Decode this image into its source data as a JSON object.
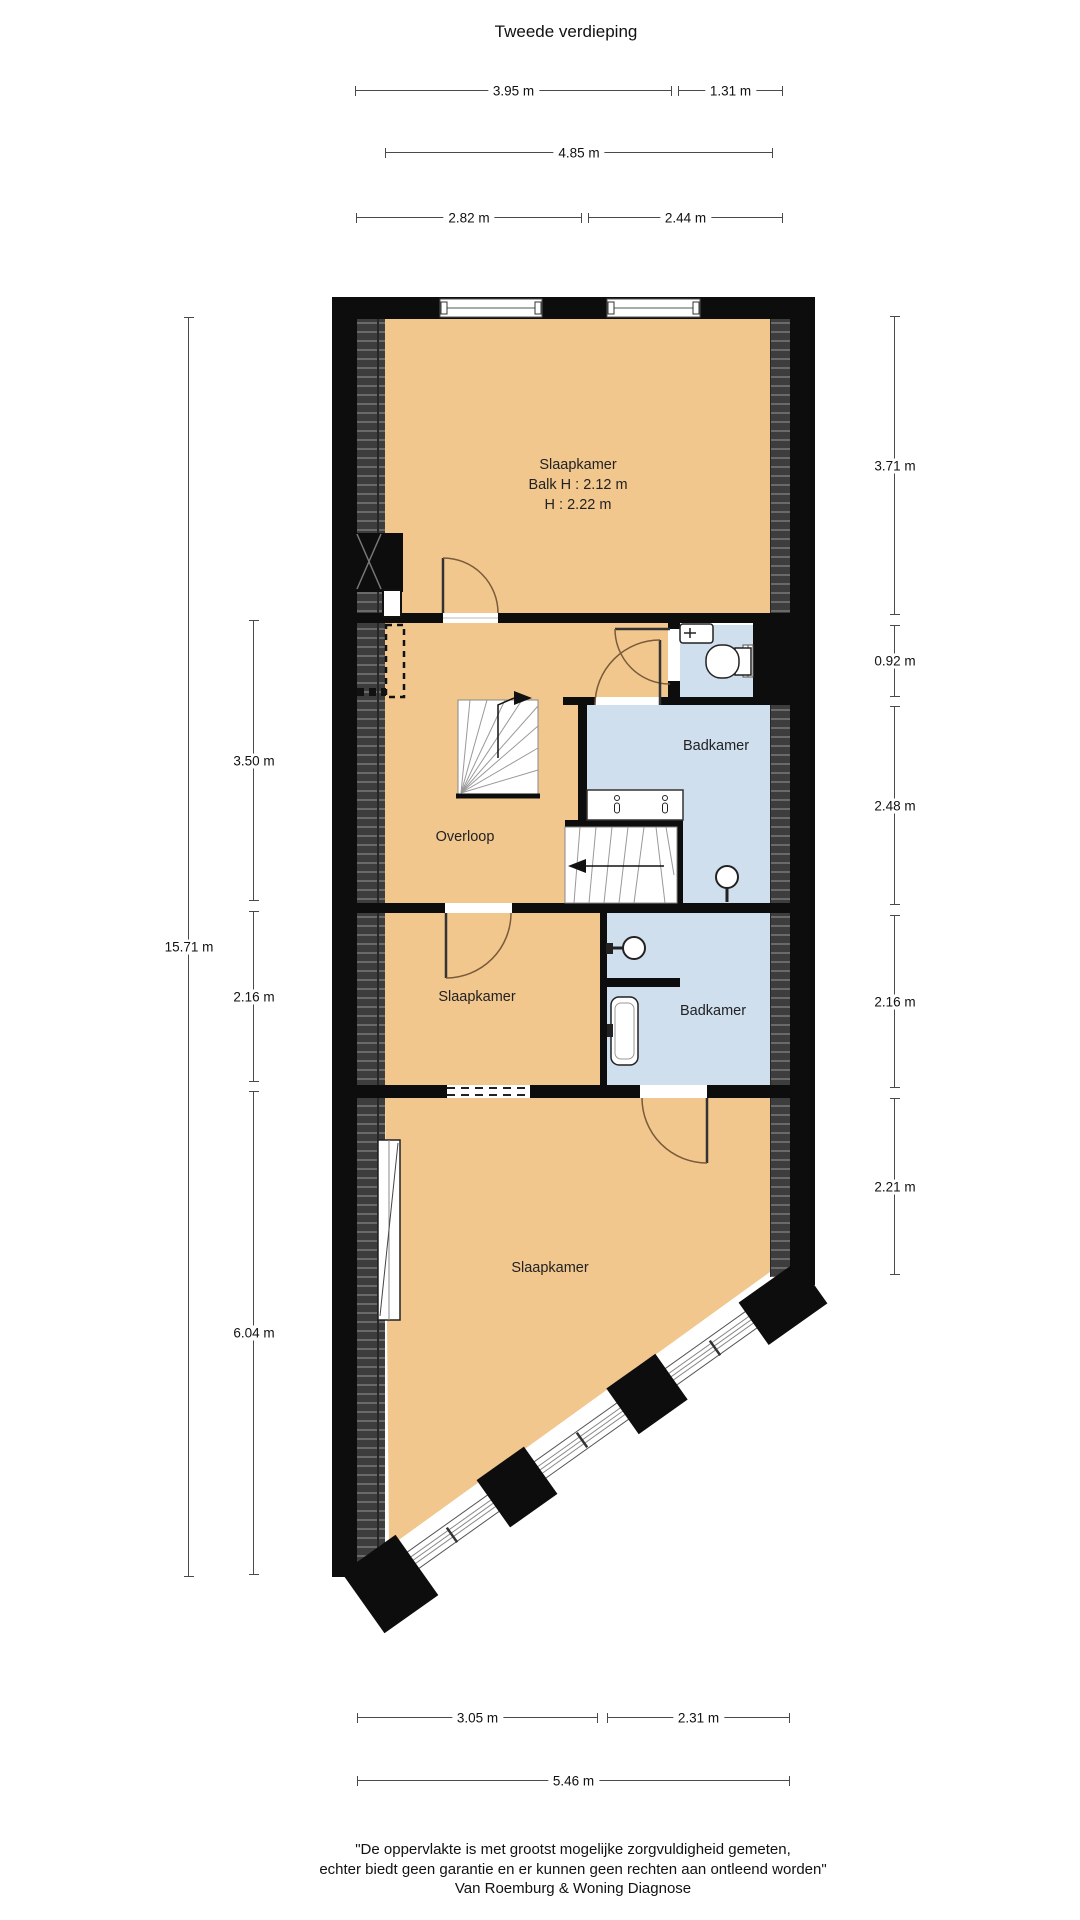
{
  "title": "Tweede verdieping",
  "dims": {
    "top": {
      "d395": "3.95 m",
      "d131": "1.31 m",
      "d485": "4.85 m",
      "d282": "2.82 m",
      "d244": "2.44 m"
    },
    "left": {
      "total": "15.71 m",
      "hall": "3.50 m",
      "row": "2.16 m",
      "bottom": "6.04 m"
    },
    "right": {
      "bedroom": "3.71 m",
      "toilet": "0.92 m",
      "bath": "2.48 m",
      "row": "2.16 m",
      "lower": "2.21 m"
    },
    "bottom": {
      "d305": "3.05 m",
      "d231": "2.31 m",
      "d546": "5.46 m"
    }
  },
  "rooms": {
    "bedroom_top": {
      "name": "Slaapkamer",
      "beam": "Balk H : 2.12 m",
      "height": "H : 2.22 m"
    },
    "hall": {
      "name": "Overloop"
    },
    "bathroom_main": {
      "name": "Badkamer"
    },
    "bedroom_small": {
      "name": "Slaapkamer"
    },
    "bathroom_second": {
      "name": "Badkamer"
    },
    "bedroom_large": {
      "name": "Slaapkamer"
    }
  },
  "fixtures": [
    "toilet",
    "hand-basin",
    "double-sink-counter",
    "shower-head",
    "washbasin",
    "staircase"
  ],
  "footer": {
    "line1": "\"De oppervlakte is met grootst mogelijke zorgvuldigheid gemeten,",
    "line2": "echter biedt geen garantie en er kunnen geen rechten aan ontleend worden\"",
    "line3": "Van Roemburg & Woning Diagnose"
  },
  "colors": {
    "floor_orange": "#f1c78e",
    "floor_blue": "#cfdfee",
    "wall_black": "#0d0d0d",
    "hatch_dark": "#3d3d3d"
  }
}
